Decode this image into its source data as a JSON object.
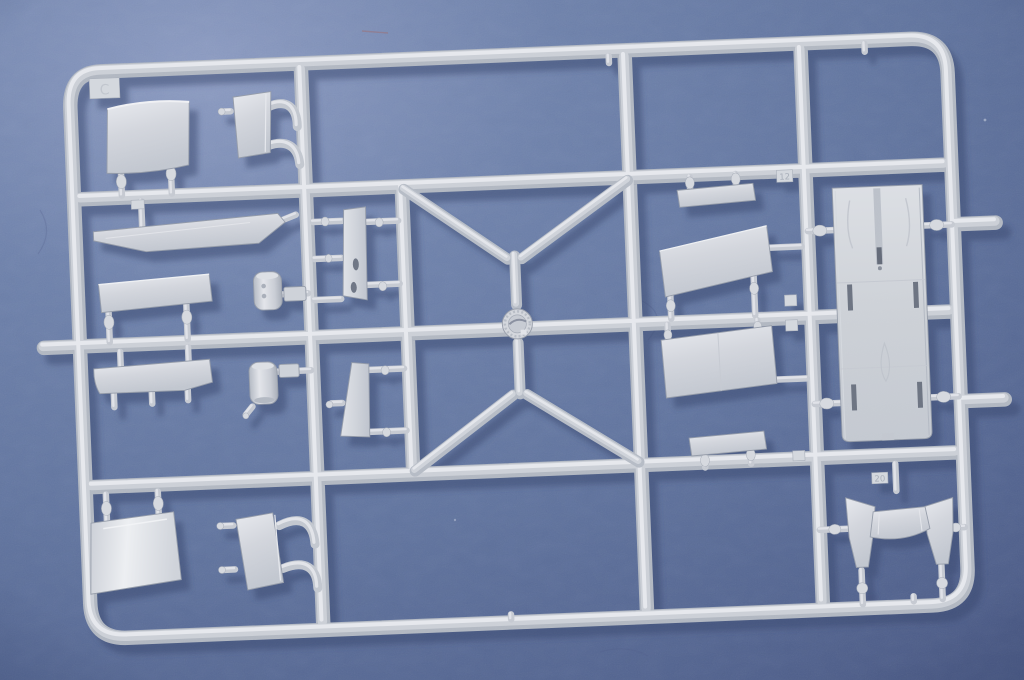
{
  "scene": {
    "description": "Photograph of a light grey injection-moulded plastic model-kit sprue (parts tree) lying slightly tilted on a blue fabric-textured backdrop",
    "colors": {
      "fabric_light": "#8b9ac0",
      "fabric_mid": "#64779f",
      "fabric_dark": "#4c5b86",
      "plastic_base": "#ccd0d7",
      "plastic_highlight": "#e8eaee",
      "plastic_shadow": "#959caa",
      "cast_shadow": "#3d4b75"
    }
  },
  "sprue": {
    "frame_tab_letter": "C",
    "part_number_tags": {
      "tag_12": "12",
      "tag_20": "20"
    },
    "layout": "Rounded-rectangle outer frame, three inner vertical rails, three horizontal rails, central X-brace with hub part",
    "parts": [
      {
        "name": "curved-dash-panel",
        "zone": "top-left"
      },
      {
        "name": "angled-bracket-with-curved-runners",
        "zone": "top-left"
      },
      {
        "name": "long-tapered-fin",
        "zone": "left"
      },
      {
        "name": "narrow-deck-strip",
        "zone": "left"
      },
      {
        "name": "curved-side-panel",
        "zone": "left"
      },
      {
        "name": "cylindrical-tank-upper",
        "zone": "left-centre"
      },
      {
        "name": "cylindrical-tank-lower",
        "zone": "left-centre"
      },
      {
        "name": "curved-windscreen-panel",
        "zone": "bottom-left"
      },
      {
        "name": "small-angled-bracket-with-curved-runners",
        "zone": "bottom-left"
      },
      {
        "name": "slatted-panel-with-two-holes",
        "zone": "centre-left-strip"
      },
      {
        "name": "tapered-blade-panel",
        "zone": "centre-left-strip"
      },
      {
        "name": "round-sight-hub",
        "zone": "centre-of-x-brace"
      },
      {
        "name": "narrow-rib-strip-upper",
        "zone": "centre-right"
      },
      {
        "name": "rectangular-hatch-panel-upper",
        "zone": "centre-right"
      },
      {
        "name": "rectangular-hatch-panel-lower",
        "zone": "centre-right"
      },
      {
        "name": "narrow-rib-strip-lower",
        "zone": "centre-right"
      },
      {
        "name": "fuselage-deck-panel-with-slots",
        "zone": "right"
      },
      {
        "name": "bowtie-canopy-frame",
        "zone": "bottom-right"
      }
    ]
  }
}
